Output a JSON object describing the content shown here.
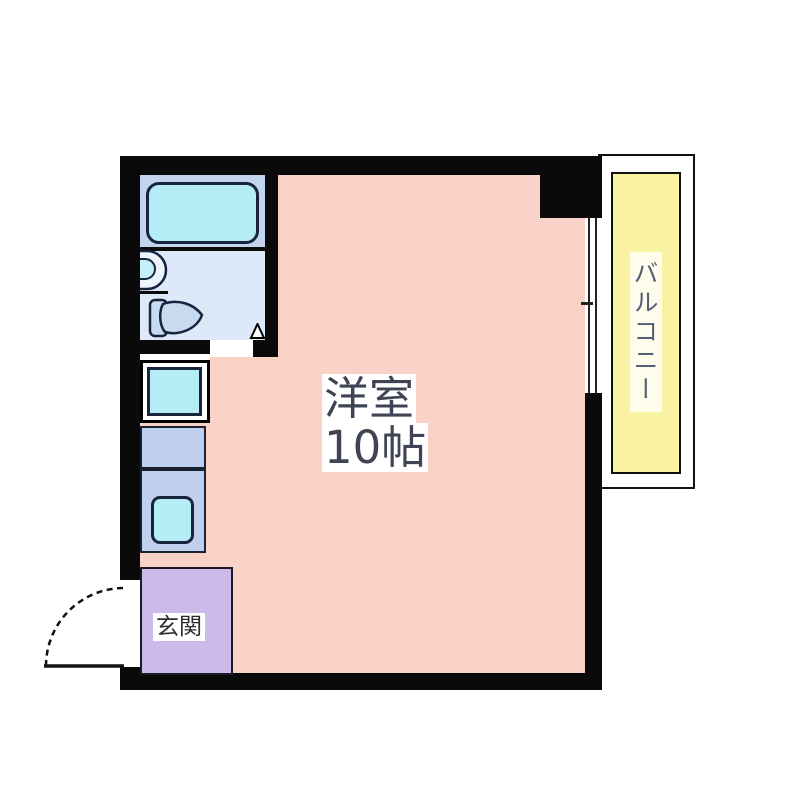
{
  "floorplan": {
    "main_room": {
      "name_label": "洋室",
      "size_label": "10帖",
      "color": "#f8d2c6"
    },
    "balcony": {
      "label": "バルコニー",
      "color": "#f9f2a2"
    },
    "entrance": {
      "label": "玄関",
      "color": "#ccbbea"
    },
    "bathroom": {
      "color_upper": "#c3d5ee",
      "color_lower": "#dde9f8"
    },
    "fixtures": [
      "bathtub",
      "washbasin",
      "toilet",
      "bathroom-door-opening",
      "washing-machine-pan",
      "kitchen-counter",
      "kitchen-sink",
      "entry-door-swing",
      "sliding-window"
    ],
    "colors": {
      "wall": "#0a0a0a",
      "fixture_cyan": "#b5ecf5",
      "fixture_blue": "#bed0ee",
      "label_text": "#3e4453",
      "balcony_text": "#555e74"
    }
  }
}
